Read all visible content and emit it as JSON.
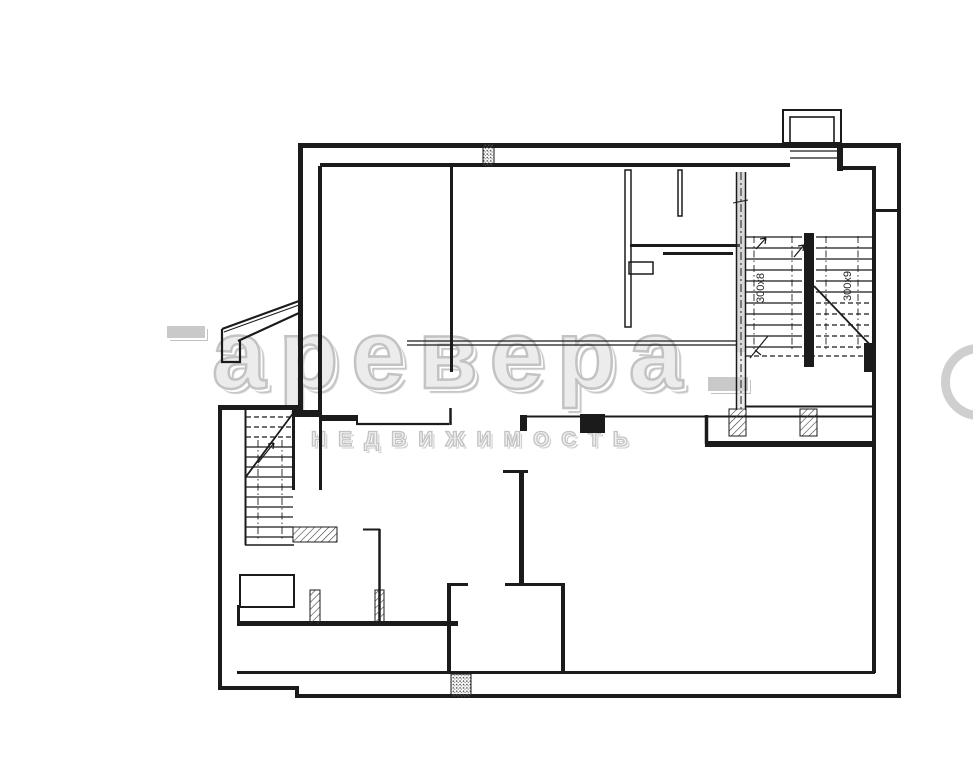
{
  "canvas": {
    "width": 973,
    "height": 768,
    "background_color": "#ffffff",
    "line_color": "#1b1b1b"
  },
  "watermark": {
    "brand_text": "аревера",
    "subtitle_text": "НЕДВИЖИМОСТЬ",
    "color": "#c9c9c9"
  },
  "plan": {
    "stairwell_top_right": {
      "flight_left_label": "300x8",
      "flight_right_label": "300x9"
    }
  }
}
